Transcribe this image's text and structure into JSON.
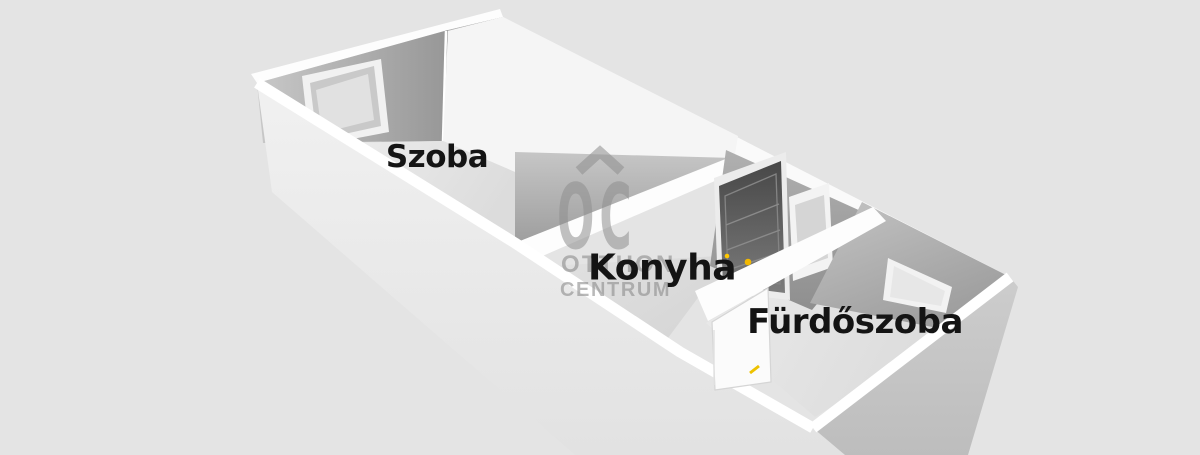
{
  "page": {
    "background": "#e4e4e4",
    "description": "3D rendered apartment floor plan"
  },
  "rooms": [
    {
      "id": "szoba",
      "label": "Szoba"
    },
    {
      "id": "konyha",
      "label": "Konyha"
    },
    {
      "id": "furdoszoba",
      "label": "Fürdőszoba"
    }
  ],
  "watermark": {
    "monogram": "OC",
    "line1": "OTTHON",
    "line2": "CENTRUM",
    "color": "#8f8f8f"
  },
  "colors": {
    "background": "#e4e4e4",
    "wall_top_white": "#ffffff",
    "wall_shadow_gray": "#9a9a9a",
    "entry_door_dark": "#5a5a5a",
    "handle_accent_yellow": "#f2c200",
    "label_text": "#141414"
  }
}
